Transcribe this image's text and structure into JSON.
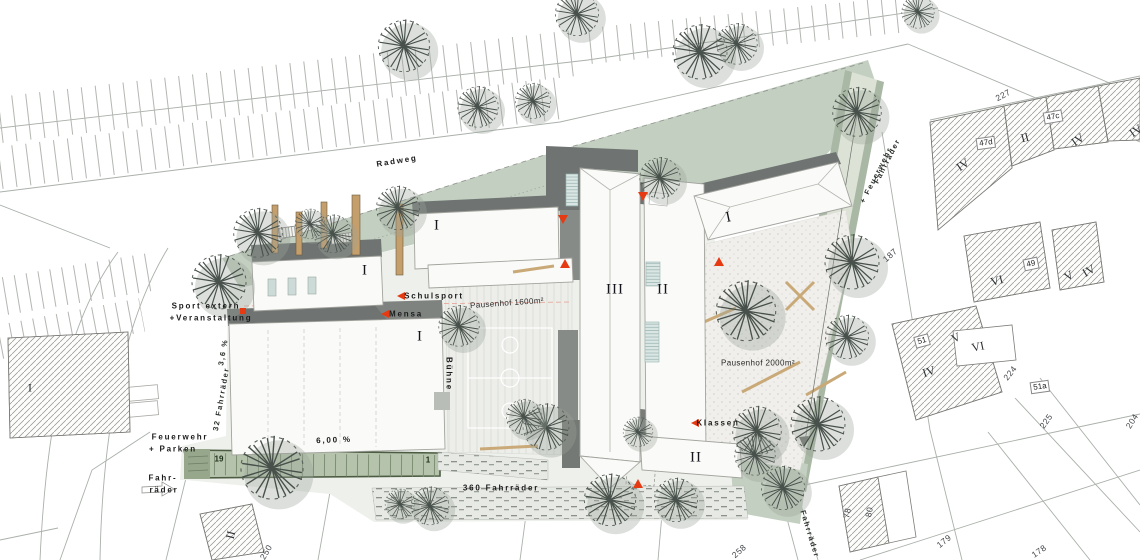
{
  "plan_type": "Lageplan Schulgelände",
  "colors": {
    "accent_red": "#e63b12",
    "sage_green": "#c3cfc0",
    "path_green": "#dce3d6",
    "lane_green": "#b5c3ac",
    "roof_dark_gray": "#6f7472",
    "timber": "#c49e6b",
    "pavement": "#eef0ec",
    "hatch_line": "#90908c",
    "tree_stroke": "#47504a"
  },
  "areas": {
    "pausenhof_1": "Pausenhof 1600m²",
    "pausenhof_2": "Pausenhof 2000m²",
    "bike_total": "360 Fahrräder",
    "bike_west": "32 Fahrräder",
    "slope_main": "6,00 %",
    "slope_west": "3,6 %"
  },
  "annotations": [
    {
      "n": "label-radweg",
      "t": "Radweg",
      "x": 397,
      "y": 161,
      "r": -9,
      "c": "sp"
    },
    {
      "n": "label-sport-extern-1",
      "t": "Sport extern",
      "x": 206,
      "y": 306,
      "r": 0,
      "c": "sp"
    },
    {
      "n": "label-sport-extern-2",
      "t": "+Veranstaltung",
      "x": 211,
      "y": 318,
      "r": 0,
      "c": "sp"
    },
    {
      "n": "label-feuerwehr-1",
      "t": "Feuerwehr",
      "x": 180,
      "y": 437,
      "r": 0,
      "c": "sp"
    },
    {
      "n": "label-feuerwehr-2",
      "t": "+ Parken",
      "x": 173,
      "y": 449,
      "r": 0,
      "c": "sp"
    },
    {
      "n": "label-fahrraeder-1",
      "t": "Fahr-",
      "x": 163,
      "y": 478,
      "r": 0,
      "c": "sp"
    },
    {
      "n": "label-fahrraeder-2",
      "t": "räder",
      "x": 164,
      "y": 490,
      "r": 0,
      "c": "sp"
    },
    {
      "n": "label-schulsport",
      "t": "Schulsport",
      "x": 434,
      "y": 296,
      "r": 0,
      "c": "sp"
    },
    {
      "n": "label-mensa",
      "t": "Mensa",
      "x": 406,
      "y": 314,
      "r": 0,
      "c": "sp"
    },
    {
      "n": "label-klassen",
      "t": "Klassen",
      "x": 718,
      "y": 423,
      "r": 0,
      "c": "sp"
    },
    {
      "n": "label-buehne",
      "t": "Bühne",
      "x": 449,
      "y": 374,
      "r": 90,
      "c": "sp"
    },
    {
      "n": "label-pausenhof-1600",
      "t": "Pausenhof 1600m²",
      "x": 507,
      "y": 303,
      "r": -4,
      "c": "pf"
    },
    {
      "n": "label-pausenhof-2000",
      "t": "Pausenhof 2000m²",
      "x": 758,
      "y": 363,
      "r": 0,
      "c": "pf"
    },
    {
      "n": "label-360-fahrraeder",
      "t": "360 Fahrräder",
      "x": 501,
      "y": 488,
      "r": 0,
      "c": "sp"
    },
    {
      "n": "label-slope-600",
      "t": "6,00 %",
      "x": 334,
      "y": 440,
      "r": -2,
      "c": "sp"
    },
    {
      "n": "label-slope-36",
      "t": "3,6 %",
      "x": 223,
      "y": 352,
      "r": -80,
      "c": "spv"
    },
    {
      "n": "label-32-fahrraeder",
      "t": "32 Fahrräder",
      "x": 221,
      "y": 399,
      "r": -80,
      "c": "spv"
    },
    {
      "n": "label-path-fahrraeder",
      "t": "Fahrräder",
      "x": 887,
      "y": 161,
      "r": -63,
      "c": "spv"
    },
    {
      "n": "label-path-feuerwehr",
      "t": "+ Feuerwehr",
      "x": 876,
      "y": 175,
      "r": -63,
      "c": "spv"
    },
    {
      "n": "label-path-south",
      "t": "Fahrräder",
      "x": 810,
      "y": 534,
      "r": 73,
      "c": "spv"
    },
    {
      "n": "building-label-1a",
      "t": "I",
      "x": 437,
      "y": 226,
      "r": 0,
      "c": "rb"
    },
    {
      "n": "building-label-1b",
      "t": "I",
      "x": 365,
      "y": 271,
      "r": 0,
      "c": "rb"
    },
    {
      "n": "building-label-1c",
      "t": "I",
      "x": 420,
      "y": 337,
      "r": 0,
      "c": "rb"
    },
    {
      "n": "building-label-1d",
      "t": "I",
      "x": 729,
      "y": 218,
      "r": -12,
      "c": "rb"
    },
    {
      "n": "building-label-2a",
      "t": "II",
      "x": 663,
      "y": 290,
      "r": 0,
      "c": "rb"
    },
    {
      "n": "building-label-2b",
      "t": "II",
      "x": 696,
      "y": 458,
      "r": 0,
      "c": "rb"
    },
    {
      "n": "building-label-3",
      "t": "III",
      "x": 615,
      "y": 290,
      "r": 0,
      "c": "rb"
    },
    {
      "n": "parcel-roman-w1",
      "t": "I",
      "x": 30,
      "y": 388,
      "r": 0,
      "c": "rp"
    },
    {
      "n": "parcel-roman-sw",
      "t": "II",
      "x": 231,
      "y": 535,
      "r": -75,
      "c": "rp"
    },
    {
      "n": "parcel-roman-e1",
      "t": "IV",
      "x": 963,
      "y": 165,
      "r": -35,
      "c": "rp"
    },
    {
      "n": "parcel-roman-e2",
      "t": "II",
      "x": 1025,
      "y": 138,
      "r": -15,
      "c": "rp"
    },
    {
      "n": "parcel-roman-e3",
      "t": "IV",
      "x": 1078,
      "y": 140,
      "r": -35,
      "c": "rp"
    },
    {
      "n": "parcel-roman-e4",
      "t": "IV",
      "x": 1136,
      "y": 131,
      "r": -35,
      "c": "rp"
    },
    {
      "n": "parcel-roman-e5",
      "t": "VI",
      "x": 997,
      "y": 281,
      "r": -15,
      "c": "rp"
    },
    {
      "n": "parcel-roman-e6",
      "t": "V",
      "x": 1069,
      "y": 276,
      "r": -30,
      "c": "rp"
    },
    {
      "n": "parcel-roman-e7",
      "t": "IV",
      "x": 1089,
      "y": 271,
      "r": -30,
      "c": "rp"
    },
    {
      "n": "parcel-roman-e8",
      "t": "V",
      "x": 956,
      "y": 338,
      "r": -25,
      "c": "rp"
    },
    {
      "n": "parcel-roman-e9",
      "t": "VI",
      "x": 978,
      "y": 347,
      "r": -12,
      "c": "rp"
    },
    {
      "n": "parcel-roman-e10",
      "t": "IV",
      "x": 929,
      "y": 372,
      "r": -18,
      "c": "rp"
    },
    {
      "n": "parcel-num-227",
      "t": "227",
      "x": 1003,
      "y": 95,
      "r": -28,
      "c": "nm"
    },
    {
      "n": "parcel-num-187",
      "t": "187",
      "x": 890,
      "y": 255,
      "r": -42,
      "c": "nm"
    },
    {
      "n": "parcel-num-224",
      "t": "224",
      "x": 1010,
      "y": 373,
      "r": -52,
      "c": "nm"
    },
    {
      "n": "parcel-num-225",
      "t": "225",
      "x": 1046,
      "y": 421,
      "r": -55,
      "c": "nm"
    },
    {
      "n": "parcel-num-204",
      "t": "204",
      "x": 1132,
      "y": 421,
      "r": -58,
      "c": "nm"
    },
    {
      "n": "parcel-num-178",
      "t": "178",
      "x": 1039,
      "y": 551,
      "r": -35,
      "c": "nm"
    },
    {
      "n": "parcel-num-179",
      "t": "179",
      "x": 944,
      "y": 541,
      "r": -38,
      "c": "nm"
    },
    {
      "n": "parcel-num-78",
      "t": "78",
      "x": 847,
      "y": 513,
      "r": -80,
      "c": "nm"
    },
    {
      "n": "parcel-num-80",
      "t": "80",
      "x": 869,
      "y": 512,
      "r": -80,
      "c": "nm"
    },
    {
      "n": "parcel-num-250",
      "t": "250",
      "x": 266,
      "y": 552,
      "r": -60,
      "c": "nm"
    },
    {
      "n": "parcel-num-258",
      "t": "258",
      "x": 739,
      "y": 551,
      "r": -42,
      "c": "nm"
    },
    {
      "n": "stall-num-19",
      "t": "19",
      "x": 219,
      "y": 459,
      "r": 0,
      "c": "gn"
    },
    {
      "n": "stall-num-1",
      "t": "1",
      "x": 428,
      "y": 460,
      "r": 0,
      "c": "gn"
    },
    {
      "n": "house-num-47c",
      "t": "47c",
      "x": 1053,
      "y": 117,
      "r": -10,
      "c": "bx"
    },
    {
      "n": "house-num-47d",
      "t": "47d",
      "x": 986,
      "y": 143,
      "r": -8,
      "c": "bx"
    },
    {
      "n": "house-num-49",
      "t": "49",
      "x": 1031,
      "y": 264,
      "r": -12,
      "c": "bx"
    },
    {
      "n": "house-num-51",
      "t": "51",
      "x": 922,
      "y": 341,
      "r": -15,
      "c": "bx"
    },
    {
      "n": "house-num-51a",
      "t": "51a",
      "x": 1040,
      "y": 387,
      "r": -8,
      "c": "bx"
    }
  ],
  "trees": [
    [
      404,
      46,
      1.9
    ],
    [
      478,
      107,
      1.5
    ],
    [
      533,
      101,
      1.3
    ],
    [
      577,
      14,
      1.6
    ],
    [
      700,
      52,
      2.0
    ],
    [
      737,
      44,
      1.5
    ],
    [
      857,
      112,
      1.8
    ],
    [
      918,
      12,
      1.2
    ],
    [
      258,
      233,
      1.8
    ],
    [
      219,
      282,
      2.0
    ],
    [
      333,
      234,
      1.4
    ],
    [
      398,
      208,
      1.6
    ],
    [
      310,
      224,
      1.1
    ],
    [
      459,
      326,
      1.5
    ],
    [
      546,
      427,
      1.7
    ],
    [
      524,
      417,
      1.3
    ],
    [
      660,
      178,
      1.5
    ],
    [
      852,
      262,
      2.0
    ],
    [
      847,
      337,
      1.6
    ],
    [
      746,
      311,
      2.2
    ],
    [
      818,
      424,
      2.0
    ],
    [
      757,
      431,
      1.8
    ],
    [
      272,
      468,
      2.3
    ],
    [
      400,
      504,
      1.1
    ],
    [
      430,
      506,
      1.4
    ],
    [
      610,
      500,
      1.9
    ],
    [
      676,
      500,
      1.6
    ],
    [
      638,
      432,
      1.1
    ],
    [
      755,
      455,
      1.5
    ],
    [
      783,
      488,
      1.6
    ]
  ],
  "timber_posts": [
    [
      272,
      205,
      6,
      48
    ],
    [
      296,
      212,
      6,
      43
    ],
    [
      321,
      202,
      6,
      46
    ],
    [
      352,
      195,
      8,
      60
    ],
    [
      396,
      204,
      7,
      71
    ]
  ],
  "red_markers": [
    {
      "t": "left",
      "x": 400,
      "y": 296
    },
    {
      "t": "left",
      "x": 384,
      "y": 314
    },
    {
      "t": "left",
      "x": 694,
      "y": 423
    },
    {
      "t": "sq",
      "x": 243,
      "y": 311
    },
    {
      "t": "down",
      "x": 643,
      "y": 196
    },
    {
      "t": "down",
      "x": 563,
      "y": 219
    },
    {
      "t": "up",
      "x": 565,
      "y": 264
    },
    {
      "t": "up",
      "x": 719,
      "y": 262
    },
    {
      "t": "up",
      "x": 638,
      "y": 484
    }
  ]
}
